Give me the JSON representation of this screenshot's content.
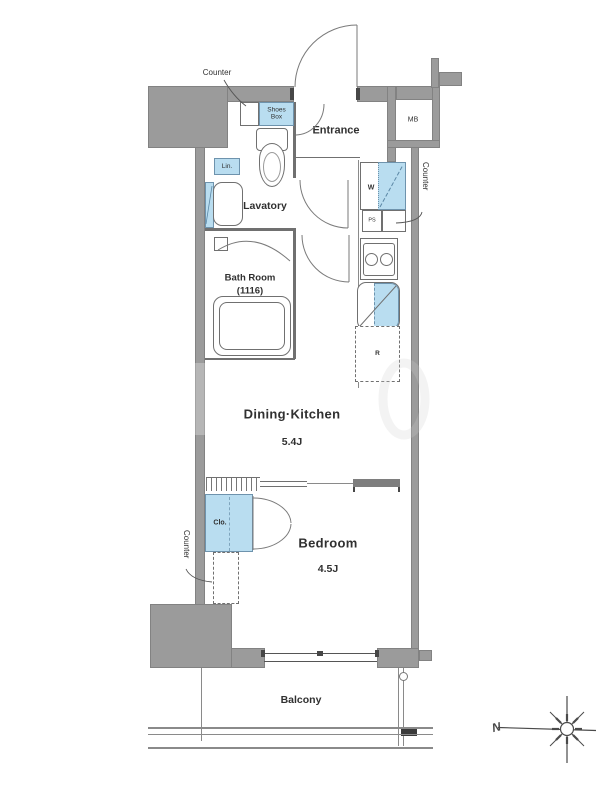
{
  "floorplan": {
    "rooms": {
      "entrance": {
        "label": "Entrance"
      },
      "lavatory": {
        "label": "Lavatory"
      },
      "bath_room": {
        "label": "Bath Room",
        "size": "(1116)"
      },
      "dining_kitchen": {
        "label": "Dining·Kitchen",
        "size": "5.4J"
      },
      "bedroom": {
        "label": "Bedroom",
        "size": "4.5J"
      },
      "balcony": {
        "label": "Balcony"
      }
    },
    "fixtures": {
      "shoes_box": "Shoes Box",
      "linen": "Lin.",
      "washer": "W",
      "pipe_space": "PS",
      "refrigerator": "R",
      "meter_box": "MB",
      "closet": "Clo."
    },
    "annotations": {
      "counter_top": "Counter",
      "counter_right": "Counter",
      "counter_left": "Counter",
      "north": "N"
    },
    "colors": {
      "wall": "#9b9b9b",
      "wall_border": "#828282",
      "fixture_blue": "#b9ddf0",
      "fixture_blue_border": "#6e93ad",
      "line": "#707070",
      "text": "#303030"
    }
  }
}
